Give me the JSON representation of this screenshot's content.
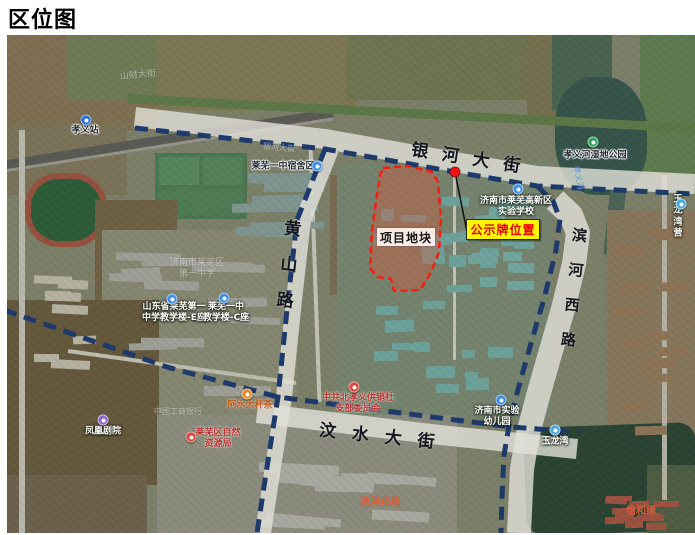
{
  "title": "区位图",
  "map": {
    "road_labels": [
      {
        "id": "yinhe-dajie",
        "text": "银河大街",
        "x": 466,
        "y": 122,
        "rot": 9,
        "size": 17,
        "ls": 14,
        "vertical": false
      },
      {
        "id": "huangshan-lu",
        "text": "黄山路",
        "x": 279,
        "y": 238,
        "rot": 6,
        "size": 17,
        "ls": 19,
        "vertical": true
      },
      {
        "id": "binhe-xi-lu",
        "text": "滨河西路",
        "x": 566,
        "y": 262,
        "rot": 6,
        "size": 15,
        "ls": 20,
        "vertical": true
      },
      {
        "id": "wenshui-dajie",
        "text": "汶水大街",
        "x": 378,
        "y": 400,
        "rot": 6,
        "size": 17,
        "ls": 16,
        "vertical": false
      }
    ],
    "pois": [
      {
        "id": "xiaoyi-station",
        "text": "孝义站",
        "x": 78,
        "y": 96,
        "style": "dark",
        "icon": {
          "type": "metro-blue",
          "x": 79,
          "y": 85
        }
      },
      {
        "id": "shancai-dajie-faint",
        "text": "山财大街",
        "x": 131,
        "y": 41,
        "style": "faint",
        "size": 9,
        "rot": -5
      },
      {
        "id": "yinhe-basemap-faint",
        "text": "银河大街",
        "x": 272,
        "y": 113,
        "style": "faint",
        "size": 8,
        "rot": 6
      },
      {
        "id": "laiwu-yizhong-dorm",
        "text": "莱芜一中宿舍区",
        "x": 276,
        "y": 132,
        "style": "dark",
        "icon": {
          "type": "edu-blue",
          "x": 310,
          "y": 131
        }
      },
      {
        "id": "xiaoyihe-wetland-park",
        "text": "孝义河湿地公园",
        "x": 588,
        "y": 121,
        "style": "dark",
        "icon": {
          "type": "park-green",
          "x": 586,
          "y": 107
        }
      },
      {
        "id": "xiaoyihe-river",
        "text": "孝义河",
        "x": 571,
        "y": 143,
        "style": "water",
        "size": 8,
        "rot": 78
      },
      {
        "id": "laiwu-hitech-experimental-school",
        "text": "济南市莱芜高新区\n实验学校",
        "x": 509,
        "y": 172,
        "style": "light",
        "icon": {
          "type": "edu-blue",
          "x": 511,
          "y": 154
        }
      },
      {
        "id": "laiwu-no1-middle-school-faint",
        "text": "济南市莱芜区\n第一中学",
        "x": 190,
        "y": 234,
        "style": "faint",
        "size": 9
      },
      {
        "id": "shandong-laiwu-no1-teaching-bldg-e",
        "text": "山东省莱芜第一\n中学教学楼-E座",
        "x": 167,
        "y": 278,
        "style": "light",
        "icon": {
          "type": "edu-blue",
          "x": 165,
          "y": 264
        }
      },
      {
        "id": "laiwu-yizhong-teaching-bldg-c",
        "text": "莱芜一中\n教学楼-C座",
        "x": 219,
        "y": 278,
        "style": "light",
        "icon": {
          "type": "edu-blue",
          "x": 217,
          "y": 263
        }
      },
      {
        "id": "ashui-dabeicha",
        "text": "阿水大杯茶",
        "x": 243,
        "y": 371,
        "style": "orange",
        "icon": {
          "type": "food-orange",
          "x": 240,
          "y": 359
        }
      },
      {
        "id": "cpc-beixiaoyi-branch",
        "text": "中共北孝义供销社\n支部委员会",
        "x": 351,
        "y": 369,
        "style": "red",
        "icon": {
          "type": "gov-red",
          "x": 347,
          "y": 352
        }
      },
      {
        "id": "jinan-experimental-kindergarten",
        "text": "济南市实验\n幼儿园",
        "x": 490,
        "y": 382,
        "style": "light",
        "icon": {
          "type": "edu-blue",
          "x": 494,
          "y": 365
        }
      },
      {
        "id": "laiwu-natural-resources-bureau",
        "text": "莱芜区自然\n资源局",
        "x": 211,
        "y": 404,
        "style": "red",
        "icon": {
          "type": "gov-red",
          "x": 184,
          "y": 402
        }
      },
      {
        "id": "fenghuang-theater",
        "text": "凤凰剧院",
        "x": 96,
        "y": 397,
        "style": "light",
        "icon": {
          "type": "purple",
          "x": 96,
          "y": 385
        }
      },
      {
        "id": "icbc-faint",
        "text": "中国工商银行",
        "x": 171,
        "y": 377,
        "style": "faint",
        "size": 8
      },
      {
        "id": "binhe-huayuan",
        "text": "滨河花苑",
        "x": 373,
        "y": 468,
        "style": "estate",
        "size": 10
      },
      {
        "id": "yihe-yuan",
        "text": "怡和缘",
        "x": 634,
        "y": 477,
        "style": "estate",
        "size": 10
      },
      {
        "id": "yulongwan",
        "text": "玉龙湾",
        "x": 548,
        "y": 407,
        "style": "light",
        "icon": {
          "type": "scenic-blue",
          "x": 548,
          "y": 395
        }
      },
      {
        "id": "yulongwan-east",
        "text": "玉龙湾营",
        "x": 671,
        "y": 182,
        "style": "light",
        "icon": {
          "type": "scenic-blue",
          "x": 674,
          "y": 169
        }
      },
      {
        "id": "yin-edge-partial",
        "text": "银",
        "x": 687,
        "y": 150,
        "style": "faint",
        "size": 9
      }
    ],
    "annotations": {
      "parcel_label": "项目地块",
      "notice_label": "公示牌位置"
    }
  }
}
